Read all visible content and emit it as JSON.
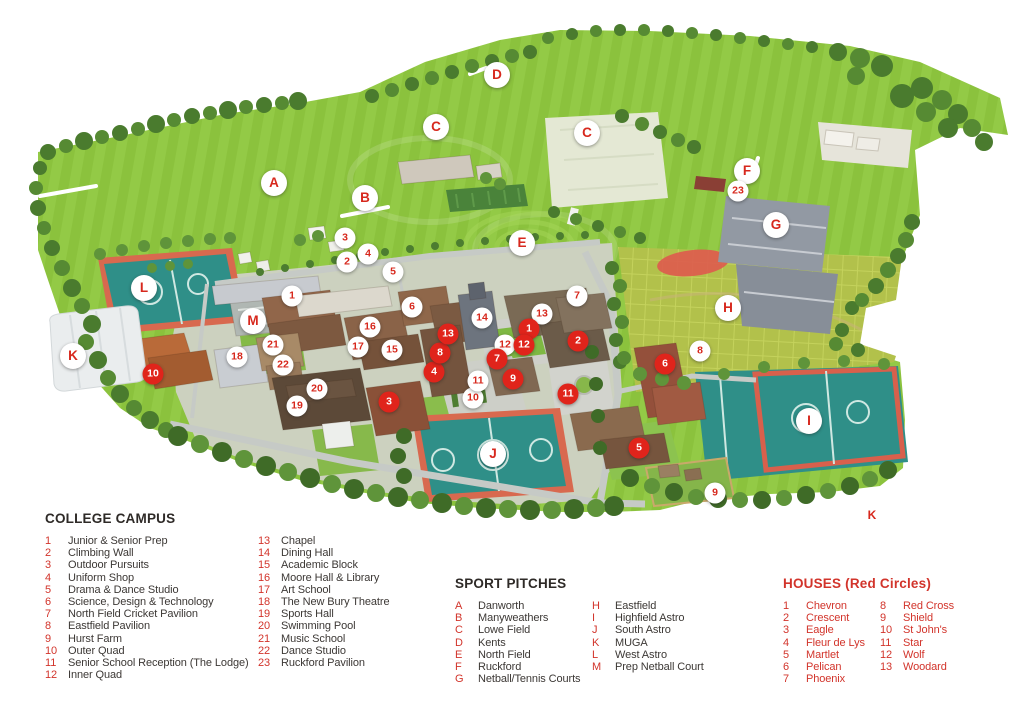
{
  "map": {
    "title": "College campus aerial map",
    "marker_colors": {
      "red_fill": "#e0241b",
      "white_fill": "#ffffff",
      "label_red": "#d7281d"
    },
    "markers": {
      "letters": [
        {
          "label": "A",
          "x": 274,
          "y": 183
        },
        {
          "label": "B",
          "x": 365,
          "y": 198
        },
        {
          "label": "C",
          "x": 436,
          "y": 127
        },
        {
          "label": "C",
          "x": 587,
          "y": 133
        },
        {
          "label": "D",
          "x": 497,
          "y": 75
        },
        {
          "label": "E",
          "x": 522,
          "y": 243
        },
        {
          "label": "F",
          "x": 747,
          "y": 171
        },
        {
          "label": "G",
          "x": 776,
          "y": 225
        },
        {
          "label": "H",
          "x": 728,
          "y": 308
        },
        {
          "label": "I",
          "x": 809,
          "y": 421
        },
        {
          "label": "J",
          "x": 493,
          "y": 454
        },
        {
          "label": "K",
          "x": 73,
          "y": 356
        },
        {
          "label": "L",
          "x": 144,
          "y": 288
        },
        {
          "label": "M",
          "x": 253,
          "y": 321
        }
      ],
      "campus_numbers": [
        {
          "label": "1",
          "x": 292,
          "y": 296
        },
        {
          "label": "2",
          "x": 347,
          "y": 262
        },
        {
          "label": "3",
          "x": 345,
          "y": 238
        },
        {
          "label": "4",
          "x": 368,
          "y": 254
        },
        {
          "label": "5",
          "x": 393,
          "y": 272
        },
        {
          "label": "6",
          "x": 412,
          "y": 307
        },
        {
          "label": "7",
          "x": 577,
          "y": 296
        },
        {
          "label": "8",
          "x": 700,
          "y": 351
        },
        {
          "label": "9",
          "x": 715,
          "y": 493
        },
        {
          "label": "10",
          "x": 473,
          "y": 398
        },
        {
          "label": "11",
          "x": 478,
          "y": 381
        },
        {
          "label": "12",
          "x": 505,
          "y": 345
        },
        {
          "label": "13",
          "x": 542,
          "y": 314
        },
        {
          "label": "14",
          "x": 482,
          "y": 318
        },
        {
          "label": "15",
          "x": 392,
          "y": 350
        },
        {
          "label": "16",
          "x": 370,
          "y": 327
        },
        {
          "label": "17",
          "x": 358,
          "y": 347
        },
        {
          "label": "18",
          "x": 237,
          "y": 357
        },
        {
          "label": "19",
          "x": 297,
          "y": 406
        },
        {
          "label": "20",
          "x": 317,
          "y": 389
        },
        {
          "label": "21",
          "x": 273,
          "y": 345
        },
        {
          "label": "22",
          "x": 283,
          "y": 365
        },
        {
          "label": "23",
          "x": 738,
          "y": 191
        }
      ],
      "houses": [
        {
          "label": "1",
          "x": 529,
          "y": 329
        },
        {
          "label": "2",
          "x": 578,
          "y": 341
        },
        {
          "label": "3",
          "x": 389,
          "y": 402
        },
        {
          "label": "4",
          "x": 434,
          "y": 372
        },
        {
          "label": "5",
          "x": 639,
          "y": 448
        },
        {
          "label": "6",
          "x": 665,
          "y": 364
        },
        {
          "label": "7",
          "x": 497,
          "y": 359
        },
        {
          "label": "8",
          "x": 440,
          "y": 353
        },
        {
          "label": "9",
          "x": 513,
          "y": 379
        },
        {
          "label": "10",
          "x": 153,
          "y": 374
        },
        {
          "label": "11",
          "x": 568,
          "y": 394
        },
        {
          "label": "12",
          "x": 524,
          "y": 345
        },
        {
          "label": "13",
          "x": 448,
          "y": 334
        }
      ],
      "plain_labels": [
        {
          "label": "K",
          "x": 872,
          "y": 515
        }
      ]
    }
  },
  "legend": {
    "college_campus": {
      "title": "COLLEGE CAMPUS",
      "columns_split": 12,
      "entries": [
        {
          "key": "1",
          "label": "Junior & Senior Prep"
        },
        {
          "key": "2",
          "label": "Climbing Wall"
        },
        {
          "key": "3",
          "label": "Outdoor Pursuits"
        },
        {
          "key": "4",
          "label": "Uniform Shop"
        },
        {
          "key": "5",
          "label": "Drama & Dance Studio"
        },
        {
          "key": "6",
          "label": "Science, Design & Technology"
        },
        {
          "key": "7",
          "label": "North Field Cricket Pavilion"
        },
        {
          "key": "8",
          "label": "Eastfield Pavilion"
        },
        {
          "key": "9",
          "label": "Hurst Farm"
        },
        {
          "key": "10",
          "label": "Outer Quad"
        },
        {
          "key": "11",
          "label": "Senior School Reception (The Lodge)"
        },
        {
          "key": "12",
          "label": "Inner Quad"
        },
        {
          "key": "13",
          "label": "Chapel"
        },
        {
          "key": "14",
          "label": "Dining Hall"
        },
        {
          "key": "15",
          "label": "Academic Block"
        },
        {
          "key": "16",
          "label": "Moore Hall & Library"
        },
        {
          "key": "17",
          "label": "Art School"
        },
        {
          "key": "18",
          "label": "The New Bury Theatre"
        },
        {
          "key": "19",
          "label": "Sports Hall"
        },
        {
          "key": "20",
          "label": "Swimming Pool"
        },
        {
          "key": "21",
          "label": "Music School"
        },
        {
          "key": "22",
          "label": "Dance Studio"
        },
        {
          "key": "23",
          "label": "Ruckford Pavilion"
        }
      ]
    },
    "sport_pitches": {
      "title": "SPORT PITCHES",
      "columns_split": 7,
      "entries": [
        {
          "key": "A",
          "label": "Danworth"
        },
        {
          "key": "B",
          "label": "Manyweathers"
        },
        {
          "key": "C",
          "label": "Lowe Field"
        },
        {
          "key": "D",
          "label": "Kents"
        },
        {
          "key": "E",
          "label": "North Field"
        },
        {
          "key": "F",
          "label": "Ruckford"
        },
        {
          "key": "G",
          "label": "Netball/Tennis Courts"
        },
        {
          "key": "H",
          "label": "Eastfield"
        },
        {
          "key": "I",
          "label": "Highfield Astro"
        },
        {
          "key": "J",
          "label": "South Astro"
        },
        {
          "key": "K",
          "label": "MUGA"
        },
        {
          "key": "L",
          "label": "West Astro"
        },
        {
          "key": "M",
          "label": "Prep Netball Court"
        }
      ]
    },
    "houses": {
      "title": "HOUSES (Red Circles)",
      "columns_split": 7,
      "entries": [
        {
          "key": "1",
          "label": "Chevron"
        },
        {
          "key": "2",
          "label": "Crescent"
        },
        {
          "key": "3",
          "label": "Eagle"
        },
        {
          "key": "4",
          "label": "Fleur de Lys"
        },
        {
          "key": "5",
          "label": "Martlet"
        },
        {
          "key": "6",
          "label": "Pelican"
        },
        {
          "key": "7",
          "label": "Phoenix"
        },
        {
          "key": "8",
          "label": "Red Cross"
        },
        {
          "key": "9",
          "label": "Shield"
        },
        {
          "key": "10",
          "label": "St John's"
        },
        {
          "key": "11",
          "label": "Star"
        },
        {
          "key": "12",
          "label": "Wolf"
        },
        {
          "key": "13",
          "label": "Woodard"
        }
      ]
    }
  }
}
